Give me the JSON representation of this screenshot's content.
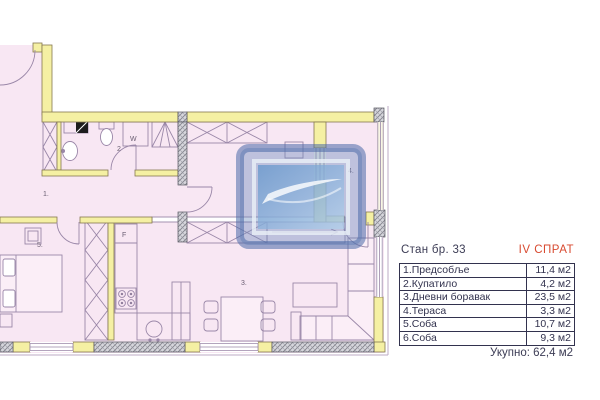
{
  "info_table": {
    "title": "Стан бр. 33",
    "floor": "IV СПРАТ",
    "columns": [
      "room",
      "area"
    ],
    "rows": [
      {
        "label": "1.Предсобље",
        "value": "11,4 м2"
      },
      {
        "label": "2.Купатило",
        "value": "4,2 м2"
      },
      {
        "label": "3.Дневни боравак",
        "value": "23,5 м2"
      },
      {
        "label": "4.Тераса",
        "value": "3,3 м2"
      },
      {
        "label": "5.Соба",
        "value": "10,7 м2"
      },
      {
        "label": "6.Соба",
        "value": "9,3 м2"
      }
    ],
    "total": "Укупно: 62,4 м2"
  },
  "plan": {
    "room_labels": {
      "hall": "1.",
      "bathroom": "2",
      "living": "3.",
      "terrace": "4.",
      "bedroom": "5."
    },
    "fixture_labels": {
      "fridge": "F",
      "washer": "W"
    },
    "colors": {
      "floor": "#f8e7f3",
      "wall": "#f5f0a3",
      "wall_outline": "#85784f",
      "hatch_wall": "#d6d6dc",
      "furniture_line": "#9a87a8",
      "watermark_blue": "#5d7fb5",
      "table_ink": "#32324e",
      "floor_label_red": "#d84a30"
    }
  }
}
